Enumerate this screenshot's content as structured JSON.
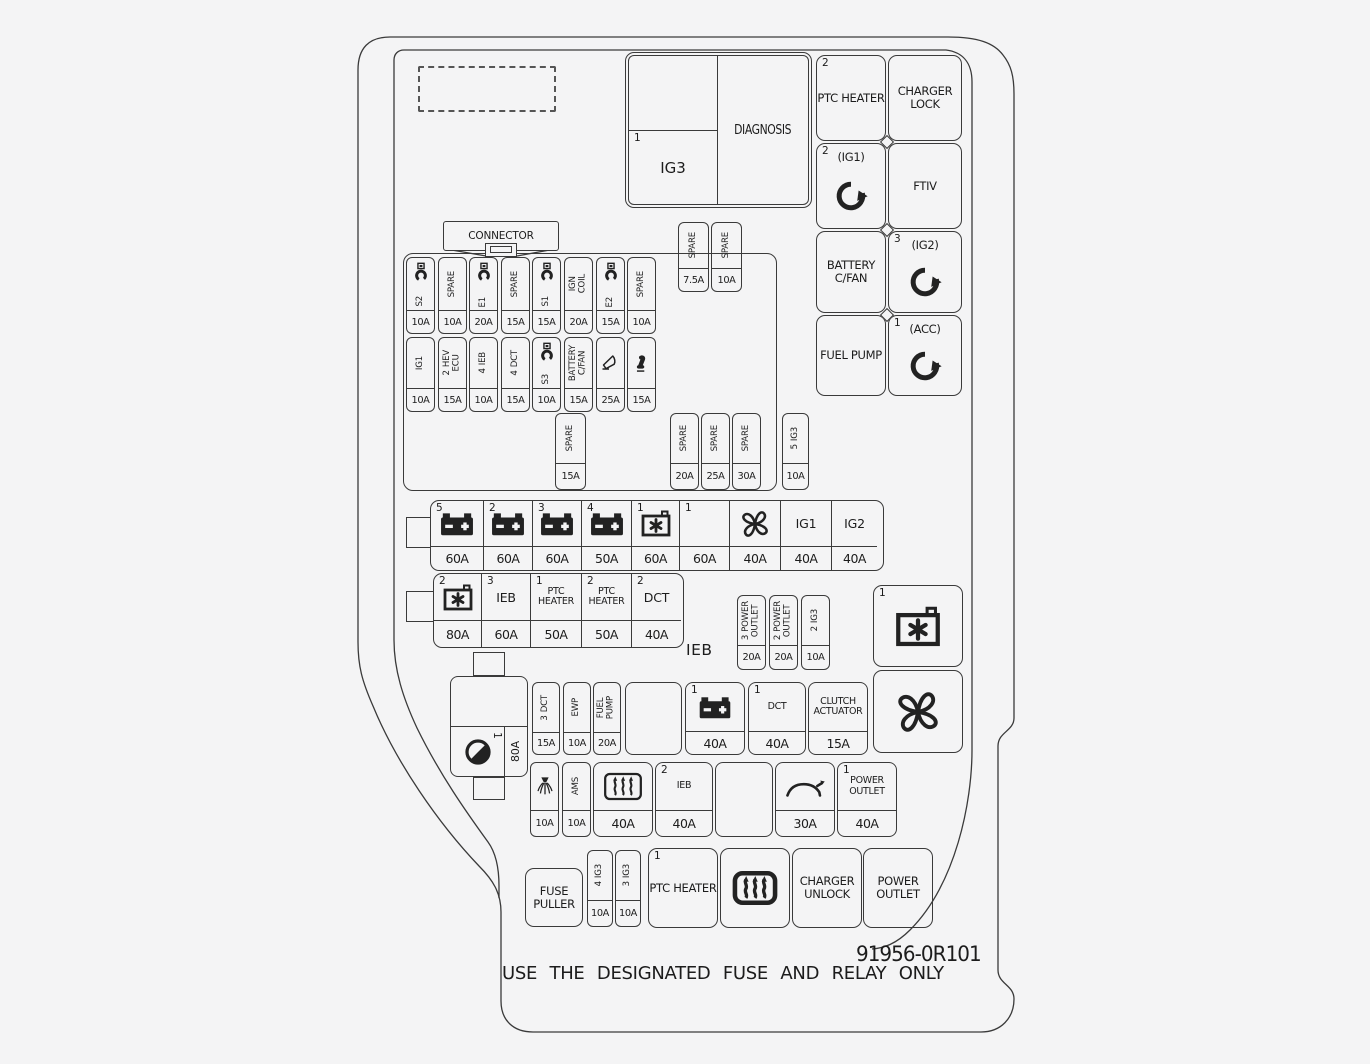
{
  "page": {
    "bg": "#f4f4f5",
    "line_color": "#3a3a3a",
    "part_number": "91956-0R101",
    "warning": "USE THE DESIGNATED FUSE AND RELAY ONLY"
  },
  "top_left_block": {
    "num": "1",
    "label": "IG3",
    "diagnosis": "DIAGNOSIS"
  },
  "right_column": [
    {
      "num": "2",
      "label": "PTC HEATER"
    },
    {
      "label": "CHARGER LOCK"
    },
    {
      "num": "2",
      "label": "(IG1)",
      "icon": "rotate-cw"
    },
    {
      "label": "FTIV"
    },
    {
      "label": "BATTERY C/FAN"
    },
    {
      "num": "3",
      "label": "(IG2)",
      "icon": "rotate-cw"
    },
    {
      "label": "FUEL PUMP"
    },
    {
      "num": "1",
      "label": "(ACC)",
      "icon": "rotate-cw"
    }
  ],
  "connector": {
    "label": "CONNECTOR"
  },
  "top_spares": [
    {
      "label": "SPARE",
      "amp": "7.5A"
    },
    {
      "label": "SPARE",
      "amp": "10A"
    }
  ],
  "fuse_row1": [
    {
      "icon": "module",
      "label": "S2",
      "amp": "10A"
    },
    {
      "label": "SPARE",
      "amp": "10A"
    },
    {
      "icon": "module",
      "label": "E1",
      "amp": "20A"
    },
    {
      "label": "SPARE",
      "amp": "15A"
    },
    {
      "icon": "module",
      "label": "S1",
      "amp": "15A"
    },
    {
      "label": "IGN\nCOIL",
      "amp": "20A"
    },
    {
      "icon": "module",
      "label": "E2",
      "amp": "15A"
    },
    {
      "label": "SPARE",
      "amp": "10A"
    }
  ],
  "fuse_row2": [
    {
      "label": "IG1",
      "amp": "10A"
    },
    {
      "num": "2",
      "label": "HEV\nECU",
      "amp": "15A"
    },
    {
      "num": "4",
      "label": "IEB",
      "amp": "10A"
    },
    {
      "num": "4",
      "label": "DCT",
      "amp": "15A"
    },
    {
      "icon": "module",
      "label": "S3",
      "amp": "10A"
    },
    {
      "label": "BATTERY\nC/FAN",
      "amp": "15A"
    },
    {
      "icon": "horn",
      "amp": "25A"
    },
    {
      "icon": "horn-filled",
      "amp": "15A"
    }
  ],
  "spare_below": {
    "label": "SPARE",
    "amp": "15A"
  },
  "spares_right": [
    {
      "label": "SPARE",
      "amp": "20A"
    },
    {
      "label": "SPARE",
      "amp": "25A"
    },
    {
      "label": "SPARE",
      "amp": "30A"
    }
  ],
  "ig3_side": {
    "num": "5",
    "label": "IG3",
    "amp": "10A"
  },
  "relay_row1": [
    {
      "num": "5",
      "icon": "battery",
      "amp": "60A"
    },
    {
      "num": "2",
      "icon": "battery",
      "amp": "60A"
    },
    {
      "num": "3",
      "icon": "battery",
      "amp": "60A"
    },
    {
      "num": "4",
      "icon": "battery",
      "amp": "50A"
    },
    {
      "num": "1",
      "icon": "battery-snowflake",
      "amp": "60A"
    },
    {
      "num": "1",
      "amp": "60A"
    },
    {
      "icon": "fan",
      "amp": "40A"
    },
    {
      "label": "IG1",
      "amp": "40A"
    },
    {
      "label": "IG2",
      "amp": "40A"
    }
  ],
  "relay_row2": [
    {
      "num": "2",
      "icon": "battery-snowflake",
      "amp": "80A"
    },
    {
      "num": "3",
      "label": "IEB",
      "amp": "60A"
    },
    {
      "num": "1",
      "label": "PTC HEATER",
      "amp": "50A"
    },
    {
      "num": "2",
      "label": "PTC HEATER",
      "amp": "50A"
    },
    {
      "num": "2",
      "label": "DCT",
      "amp": "40A"
    }
  ],
  "ieb_label": "IEB",
  "outlet_fuses": [
    {
      "num": "3",
      "label": "POWER\nOUTLET",
      "amp": "20A"
    },
    {
      "num": "2",
      "label": "POWER\nOUTLET",
      "amp": "20A"
    },
    {
      "num": "2",
      "label": "IG3",
      "amp": "10A"
    }
  ],
  "right_boxes": [
    {
      "num": "1",
      "icon": "battery-snowflake"
    },
    {
      "icon": "fan"
    }
  ],
  "dial_block": {
    "num": "1",
    "icon": "dial",
    "amp": "80A"
  },
  "rowA_fuses": [
    {
      "num": "3",
      "label": "DCT",
      "amp": "15A"
    },
    {
      "label": "EWP",
      "amp": "10A"
    },
    {
      "label": "FUEL\nPUMP",
      "amp": "20A"
    }
  ],
  "rowA_boxes": [
    {
      "amp": ""
    },
    {
      "num": "1",
      "icon": "battery",
      "amp": "40A"
    },
    {
      "num": "1",
      "label": "DCT",
      "amp": "40A"
    },
    {
      "label": "CLUTCH ACTUATOR",
      "amp": "15A"
    }
  ],
  "rowB_fuses": [
    {
      "icon": "washer",
      "amp": "10A"
    },
    {
      "label": "AMS",
      "amp": "10A"
    }
  ],
  "rowB_boxes": [
    {
      "icon": "defrost",
      "amp": "40A"
    },
    {
      "num": "2",
      "label": "IEB",
      "amp": "40A"
    },
    {
      "amp": ""
    },
    {
      "icon": "car-tailgate",
      "amp": "30A"
    },
    {
      "num": "1",
      "label": "POWER OUTLET",
      "amp": "40A"
    }
  ],
  "rowC": {
    "fuse_puller": "FUSE PULLER",
    "ig3_fuses": [
      {
        "num": "4",
        "label": "IG3",
        "amp": "10A"
      },
      {
        "num": "3",
        "label": "IG3",
        "amp": "10A"
      }
    ],
    "boxes": [
      {
        "num": "1",
        "label": "PTC HEATER"
      },
      {
        "icon": "defrost-bold"
      },
      {
        "label": "CHARGER UNLOCK"
      },
      {
        "label": "POWER OUTLET"
      }
    ]
  }
}
